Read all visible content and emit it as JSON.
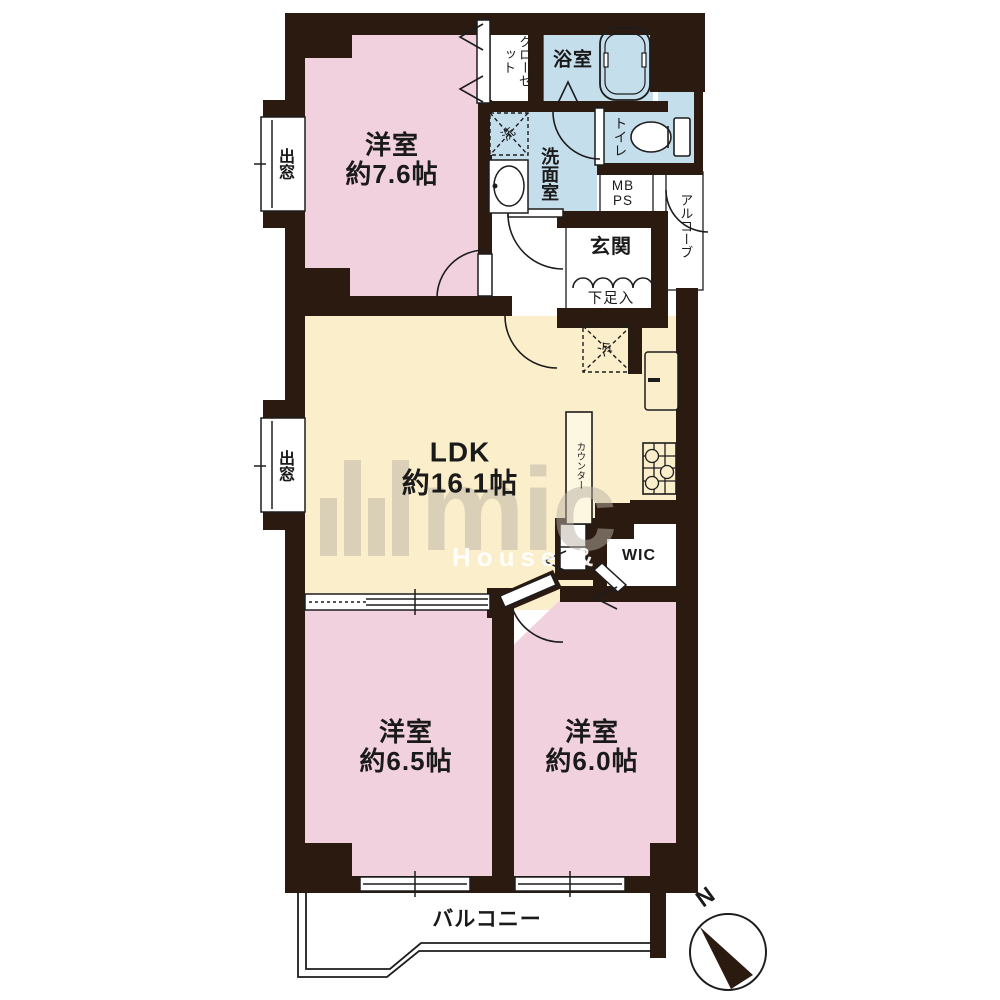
{
  "floorplan": {
    "rooms": [
      {
        "id": "bedroom-7-6",
        "name": "洋室",
        "size": "約7.6帖"
      },
      {
        "id": "ldk",
        "name": "LDK",
        "size": "約16.1帖"
      },
      {
        "id": "bedroom-6-5",
        "name": "洋室",
        "size": "約6.5帖"
      },
      {
        "id": "bedroom-6-0",
        "name": "洋室",
        "size": "約6.0帖"
      }
    ],
    "labels": {
      "closet": "クローゼット",
      "bath": "浴室",
      "laundry": "洗",
      "washroom": "洗面室",
      "toilet": "トイレ",
      "mb": "MB",
      "ps": "PS",
      "alcove": "アルコーブ",
      "entrance": "玄関",
      "shoe_cabinet": "下足入",
      "refrigerator": "冷",
      "counter": "カウンター",
      "wic": "WIC",
      "balcony": "バルコニー",
      "bay_window": "出窓",
      "north": "N"
    },
    "watermark": {
      "logo": "mic",
      "tagline": "House & Life"
    },
    "colors": {
      "wall": "#2b1a10",
      "room_pink": "#f1d1de",
      "room_yellow": "#fbeecb",
      "room_blue": "#c5deec",
      "line": "#1d1d1d",
      "white": "#ffffff"
    },
    "icons": [
      "bathtub-icon",
      "toilet-icon",
      "vanity-sink-icon",
      "washing-machine-icon",
      "refrigerator-icon",
      "kitchen-sink-icon",
      "stove-icon",
      "compass-icon",
      "door-arc",
      "window",
      "folding-door-chevron"
    ]
  }
}
